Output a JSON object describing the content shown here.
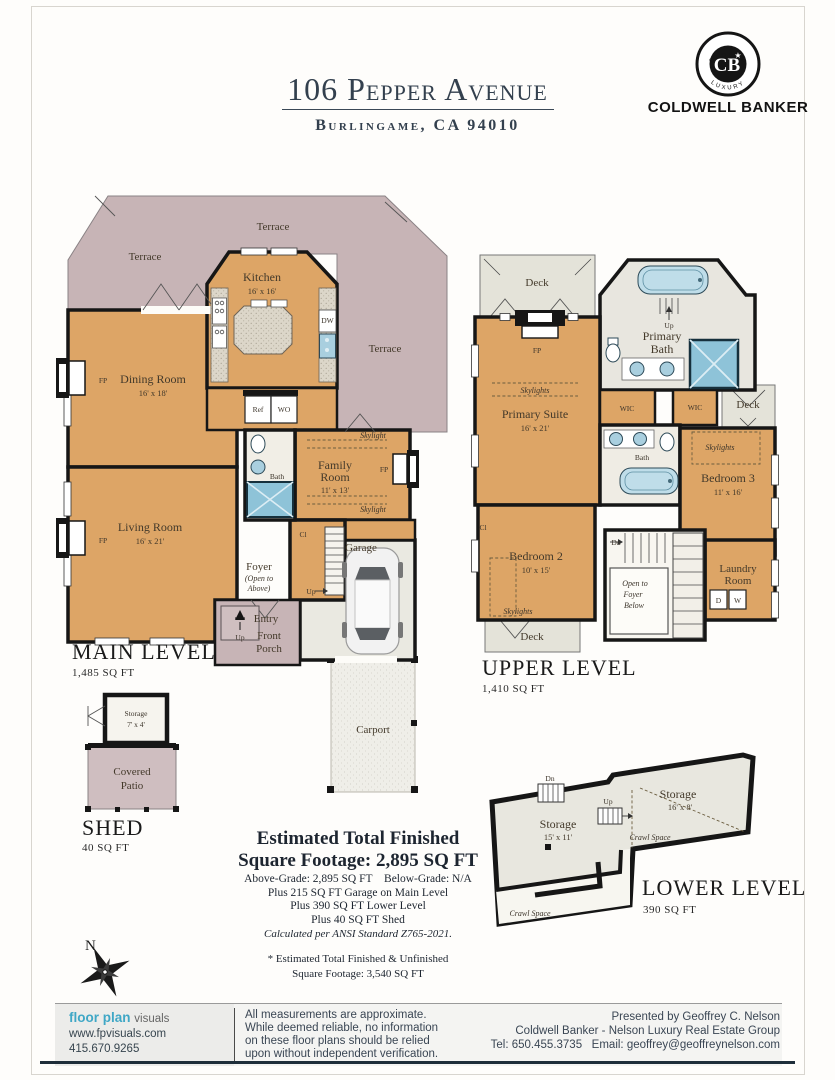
{
  "header": {
    "title": "106 Pepper Avenue",
    "subtitle": "Burlingame, CA 94010"
  },
  "brand": {
    "arc_top": "GLOBAL",
    "arc_bottom": "LUXURY",
    "monogram": "CB",
    "star": "★",
    "name": "COLDWELL BANKER"
  },
  "main_level": {
    "title": "MAIN LEVEL",
    "area": "1,485 SQ FT",
    "terrace_left": "Terrace",
    "terrace_top": "Terrace",
    "terrace_right": "Terrace",
    "kitchen_name": "Kitchen",
    "kitchen_dim": "16' x 16'",
    "dining_name": "Dining Room",
    "dining_dim": "16' x 18'",
    "living_name": "Living Room",
    "living_dim": "16' x 21'",
    "family_name1": "Family",
    "family_name2": "Room",
    "family_dim": "11' x 13'",
    "bath": "Bath",
    "foyer": "Foyer",
    "open1": "(Open to",
    "open2": "Above)",
    "up_foyer": "Up",
    "cl": "Cl",
    "entry": "Entry",
    "porch1": "Front",
    "porch2": "Porch",
    "up_porch": "Up",
    "garage": "Garage",
    "carport": "Carport",
    "skylight_top": "Skylight",
    "skylight_bottom": "Skylight",
    "fp_dining": "FP",
    "fp_living": "FP",
    "fp_family": "FP",
    "dw": "DW",
    "ref": "Ref",
    "wo": "WO"
  },
  "upper_level": {
    "title": "UPPER LEVEL",
    "area": "1,410 SQ FT",
    "deck_top": "Deck",
    "deck_right": "Deck",
    "deck_bottom": "Deck",
    "pbath1": "Primary",
    "pbath2": "Bath",
    "up": "Up",
    "suite_name": "Primary Suite",
    "suite_dim": "16' x 21'",
    "fp": "FP",
    "skylights_suite": "Skylights",
    "wic1": "WIC",
    "wic2": "WIC",
    "bath": "Bath",
    "bed3_name": "Bedroom 3",
    "bed3_dim": "11' x 16'",
    "skylights_bed3": "Skylights",
    "bed2_name": "Bedroom 2",
    "bed2_dim": "10' x 15'",
    "skylights_bed2": "Skylights",
    "dn": "Dn",
    "open1": "Open to",
    "open2": "Foyer",
    "open3": "Below",
    "laundry1": "Laundry",
    "laundry2": "Room",
    "d": "D",
    "w": "W",
    "cl": "Cl"
  },
  "lower_level": {
    "title": "LOWER LEVEL",
    "area": "390 SQ FT",
    "storage1_name": "Storage",
    "storage1_dim": "15' x 11'",
    "storage2_name": "Storage",
    "storage2_dim": "16' x 8'",
    "dn": "Dn",
    "up": "Up",
    "crawl1": "Crawl Space",
    "crawl2": "Crawl Space"
  },
  "shed": {
    "title": "SHED",
    "area": "40 SQ FT",
    "storage_name": "Storage",
    "storage_dim": "7' x 4'",
    "patio1": "Covered",
    "patio2": "Patio"
  },
  "summary": {
    "heading1": "Estimated Total Finished",
    "heading2": "Square Footage: 2,895 SQ FT",
    "line1": "Above-Grade: 2,895 SQ FT    Below-Grade: N/A",
    "line2": "Plus 215 SQ FT Garage on Main Level",
    "line3": "Plus 390 SQ FT Lower Level",
    "line4": "Plus 40 SQ FT Shed",
    "line5": "Calculated per ANSI Standard Z765-2021.",
    "note1": "* Estimated Total Finished & Unfinished",
    "note2": "Square Footage: 3,540 SQ FT"
  },
  "compass": {
    "label": "N"
  },
  "footer": {
    "logo_part1": "floor plan",
    "logo_part2": "visuals",
    "website": "www.fpvisuals.com",
    "phone": "415.670.9265",
    "disclaimer1": "All measurements are approximate.",
    "disclaimer2": "While deemed reliable, no information",
    "disclaimer3": "on these floor plans should be relied",
    "disclaimer4": "upon without independent verification.",
    "presented1": "Presented by Geoffrey C. Nelson",
    "presented2": "Coldwell Banker - Nelson Luxury Real Estate Group",
    "presented3": "Tel: 650.455.3735   Email: geoffrey@geoffreynelson.com"
  },
  "colors": {
    "room_tan": "#dda566",
    "terrace_mauve": "#c7b4b6",
    "deck_gray": "#e4e3d9",
    "fixture_blue": "#a9cfdf",
    "accent_teal": "#3fa7c6",
    "ink_navy": "#33404e",
    "footer_bar": "#1e2e3a"
  }
}
